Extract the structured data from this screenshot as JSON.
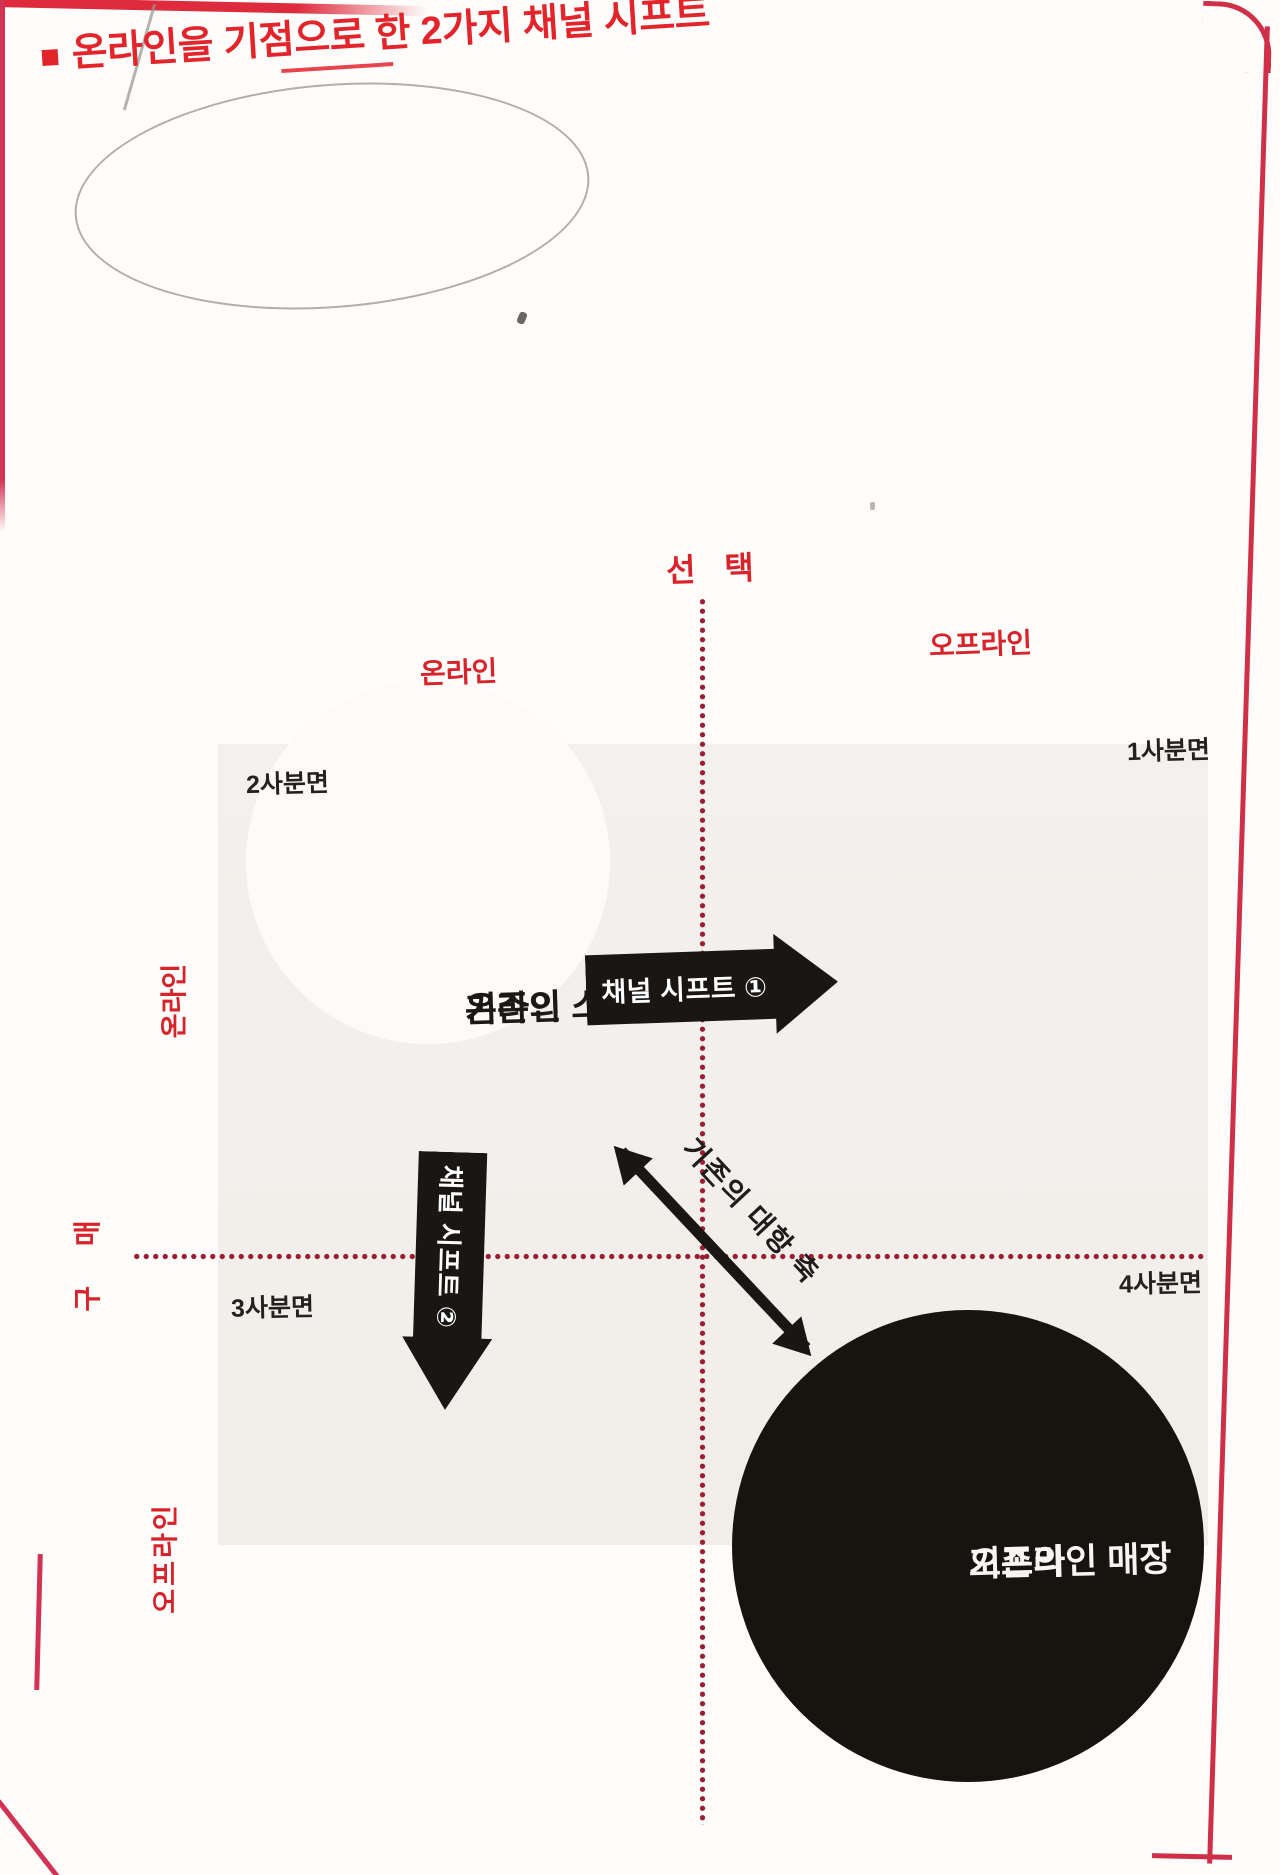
{
  "title": {
    "text": "온라인을 기점으로 한 2가지 채널 시프트"
  },
  "axes": {
    "top": "선 택",
    "left": "구 매",
    "top_left": "온라인",
    "top_right": "오프라인",
    "left_upper": "온라인",
    "left_lower": "오프라인"
  },
  "quadrant_labels": {
    "q1": "1사분면",
    "q2": "2사분면",
    "q3": "3사분면",
    "q4": "4사분면"
  },
  "nodes": {
    "online_store": {
      "line1": "기존의",
      "line2": "온라인 스토어"
    },
    "offline_store": {
      "line1": "기존의",
      "line2": "오프라인 매장"
    }
  },
  "arrows": {
    "shift1": "채널 시프트 ①",
    "shift2": "채널 시프트 ②",
    "diagonal": "기존의 대항 축"
  },
  "colors": {
    "title_red": "#e3242b",
    "label_red": "#d8232a",
    "border_pink": "#d23253",
    "dotted_line_red": "#9c1c32",
    "ink_black": "#191613",
    "plot_background": "#f2efeb",
    "page_background": "#fefdfb"
  }
}
